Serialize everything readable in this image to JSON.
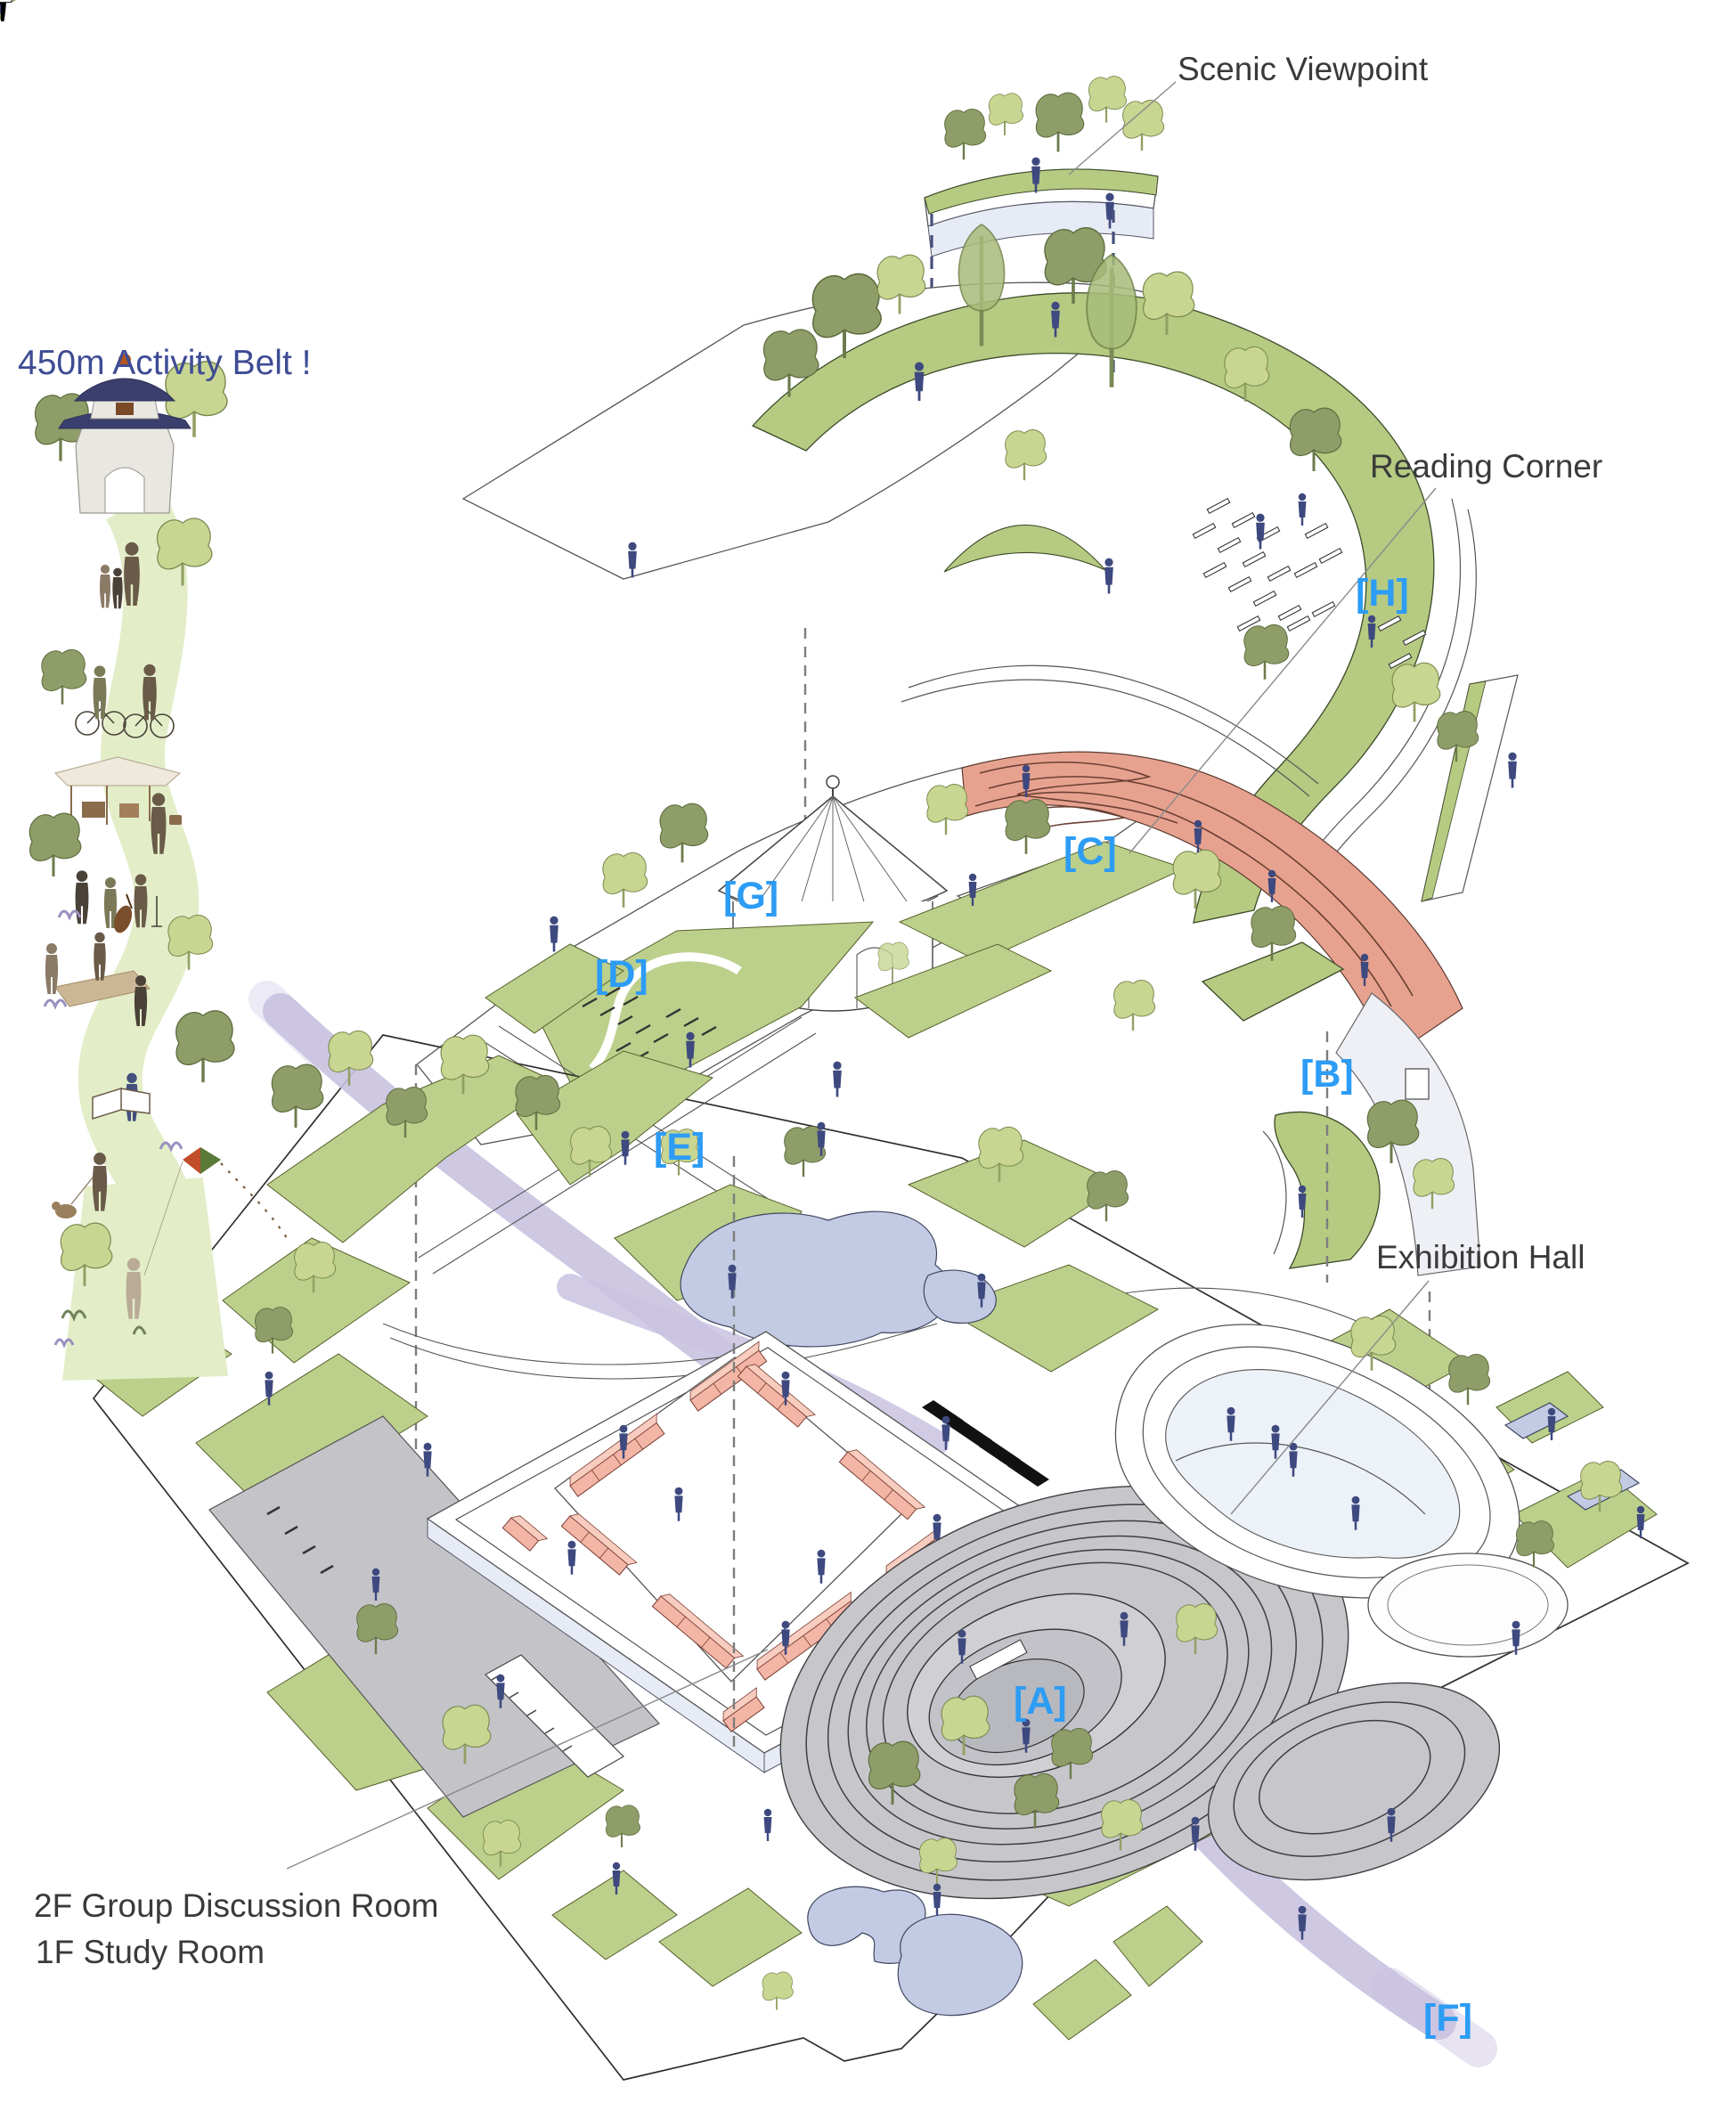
{
  "belt": {
    "title": "450m Activity Belt !"
  },
  "callouts": {
    "scenic_viewpoint": "Scenic Viewpoint",
    "reading_corner": "Reading  Corner",
    "exhibition_hall": "Exhibition Hall",
    "courtyard_2f": "2F  Group Discussion Room",
    "courtyard_1f": "1F  Study Room"
  },
  "markers": {
    "a": "[A]",
    "b": "[B]",
    "c": "[C]",
    "d": "[D]",
    "e": "[E]",
    "f": "[F]",
    "g": "[G]",
    "h": "[H]"
  },
  "colors": {
    "marker_blue": "#2d9cf4",
    "callout_gray": "#3a3a3a",
    "belt_title_navy": "#3e4c94",
    "lawn_green": "#bcd08b",
    "roof_band_green": "#b6ca82",
    "belt_ribbon_green": "#e3eec9",
    "terrace_salmon": "#e7a28f",
    "module_salmon": "#f3b5a5",
    "pond_blue": "#c2cbe3",
    "path_lavender": "#c9c2e0",
    "figure_navy": "#3e497f",
    "amphitheater_gray": "#c7c7cb"
  }
}
